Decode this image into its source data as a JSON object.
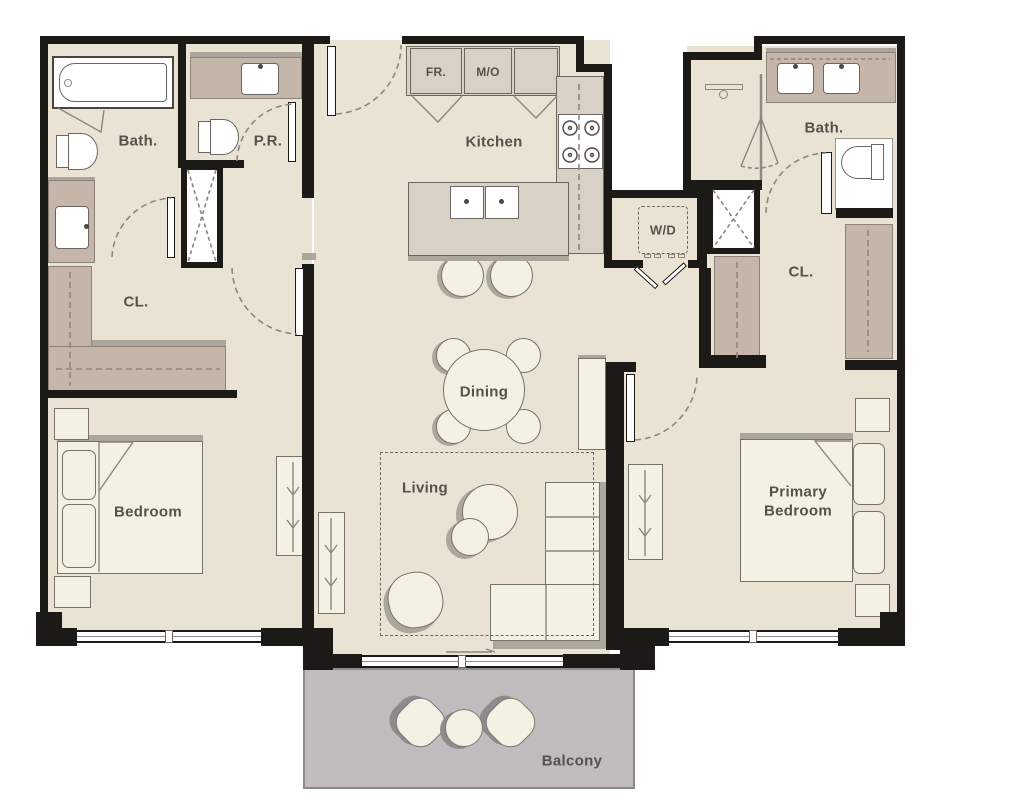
{
  "rooms": {
    "bath_left": "Bath.",
    "powder_room": "P.R.",
    "kitchen": "Kitchen",
    "closet_left": "CL.",
    "bedroom": "Bedroom",
    "dining": "Dining",
    "living": "Living",
    "laundry": "W/D",
    "closet_right": "CL.",
    "bath_right": "Bath.",
    "primary_bedroom": "Primary Bedroom",
    "balcony": "Balcony"
  },
  "appliances": {
    "fridge": "FR.",
    "microwave_oven": "M/O"
  },
  "colors": {
    "floor": "#EAE3D4",
    "wall": "#1C1A17",
    "cabinet": "#D9D1C6",
    "wood": "#C6B6A9",
    "cream": "#F4F0E3",
    "shade": "#ACA69C",
    "balcony": "#C0BCBD",
    "line": "#8D867C",
    "label": "#55514B",
    "outline": "#6B665F"
  }
}
